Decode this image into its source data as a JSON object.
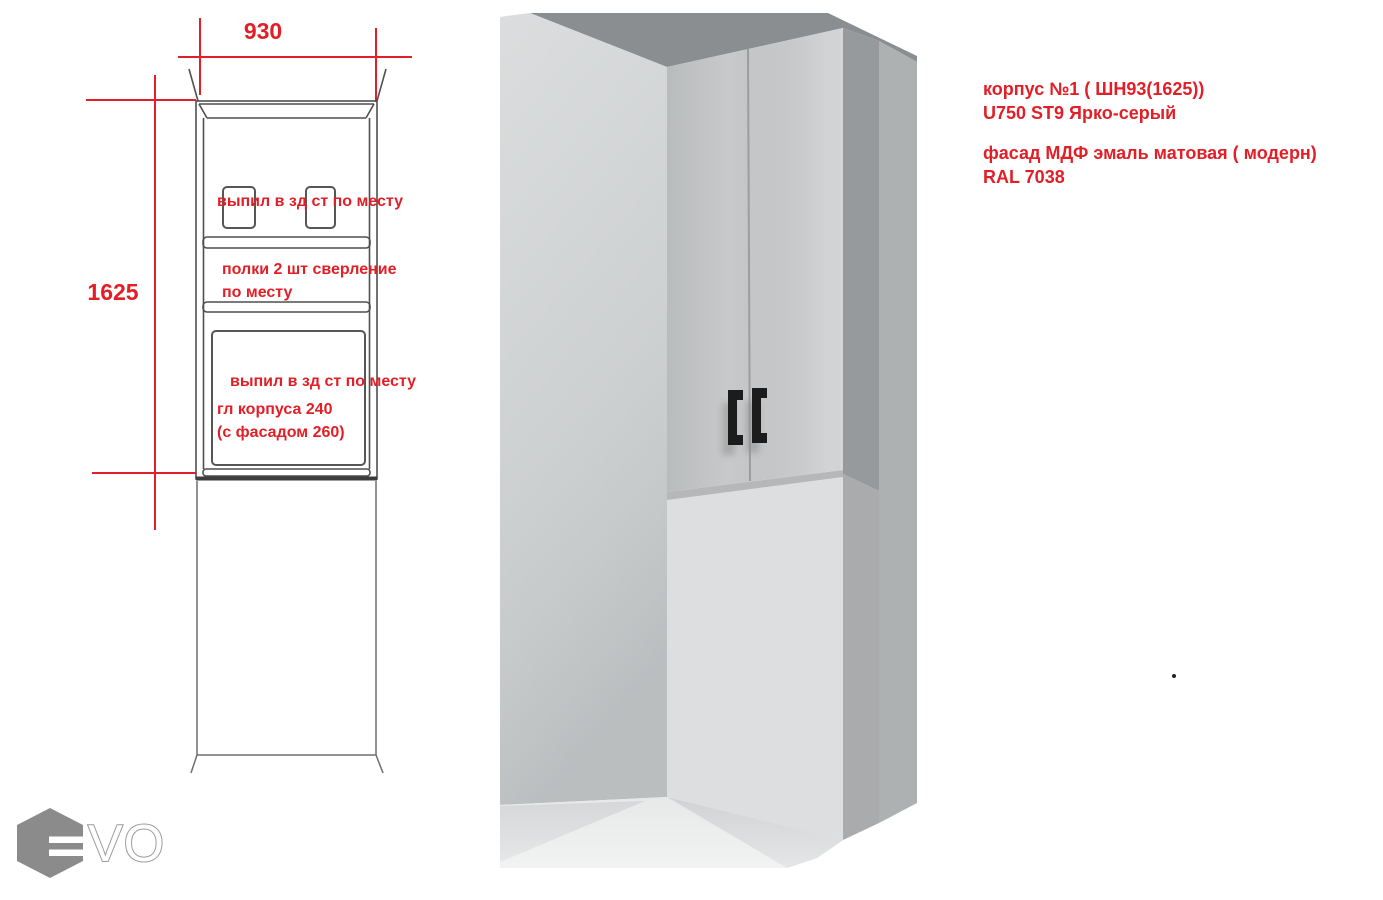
{
  "sheet": {
    "background": "#ffffff"
  },
  "drawing": {
    "dim_width_label": "930",
    "dim_height_label": "1625",
    "note_back_cut_top": "выпил в зд ст по месту",
    "note_shelves_line1": "полки 2 шт сверление",
    "note_shelves_line2": "по месту",
    "note_back_cut_bottom": "выпил в зд ст по месту",
    "note_depth_line1": "гл корпуса 240",
    "note_depth_line2": "(с фасадом 260)",
    "accent_color": "#e21e26",
    "line_color": "#4f4f4f"
  },
  "annotations": {
    "line1": "корпус №1 ( ШН93(1625))",
    "line2": "U750 ST9 Ярко-серый",
    "line3": "фасад МДФ эмаль матовая ( модерн)",
    "line4": "RAL 7038",
    "color": "#e21e26"
  },
  "render3d": {
    "colors": {
      "ceiling": "#8b8e90",
      "left_wall": "#c9cccd",
      "doors": "#c7c9ca",
      "door_seam": "#9b9ea0",
      "door_edge_highlight": "#d6d8d9",
      "cabinet_bottom_band": "#b5b7b8",
      "wall_below": "#dcdedf",
      "side_panel_upper": "#969a9c",
      "side_panel_lower": "#a9abac",
      "side_wall_right": "#aeb1b2",
      "floor_bright": "#e7e8e8",
      "floor_left": "#d4d6d7",
      "floor_wedge": "#d0d2d3",
      "handle": "#1c1c1c"
    }
  },
  "logo": {
    "text": "VO",
    "hexagon_color": "#8b8b8b",
    "outline_color": "#9a9a9a"
  }
}
